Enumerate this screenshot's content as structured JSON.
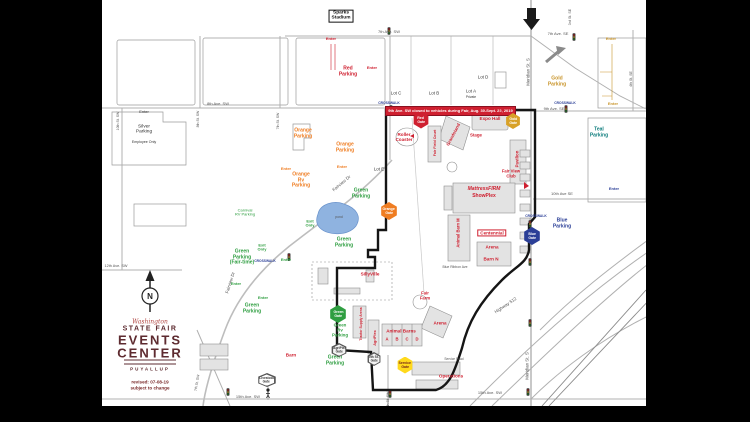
{
  "colors": {
    "accent_red": "#cf2030",
    "orange": "#ef7d22",
    "gold": "#c9952b",
    "green": "#2f9e41",
    "blue": "#2b3f97",
    "teal": "#0e7d7d",
    "maroon": "#5e2b30",
    "pond": "#8fb3e0",
    "boundary": "#151515"
  },
  "banner": {
    "text": "9th Ave. SW closed to vehicles during Fair, Aug. 30-Sept. 22, 2019"
  },
  "logo": {
    "script": "Washington",
    "name": "STATE FAIR",
    "big1": "EVENTS",
    "big2": "CENTER",
    "city": "PUYALLUP",
    "revised": "revised:  07-08-19",
    "subject": "subject to change",
    "compass_n": "N"
  },
  "labels": [
    {
      "id": "sparks-stadium-label",
      "lines": [
        "Sparks",
        "Stadium"
      ],
      "x": 239,
      "y": 16,
      "c": "black",
      "s": 4.8,
      "box": true
    },
    {
      "id": "street-7th-ave-sw",
      "t": "7th Ave. SW",
      "x": 287,
      "y": 32,
      "c": "street",
      "s": 4,
      "b": false
    },
    {
      "id": "street-7th-ave-se",
      "t": "7th Ave. SE",
      "x": 456,
      "y": 34,
      "c": "street",
      "s": 4,
      "b": false
    },
    {
      "id": "street-3rd-st-se",
      "t": "3rd St. SE",
      "x": 468,
      "y": 17,
      "c": "street",
      "s": 3.6,
      "b": false,
      "r": -90
    },
    {
      "id": "street-meridian-st-n",
      "t": "Meridian St. S",
      "x": 427,
      "y": 72,
      "c": "street",
      "s": 4.4,
      "b": false,
      "r": -90
    },
    {
      "id": "street-8th-ave-sw",
      "t": "8th Ave. SW",
      "x": 116,
      "y": 104,
      "c": "street",
      "s": 4,
      "b": false
    },
    {
      "id": "street-9th-ave-se",
      "t": "9th Ave. SE",
      "x": 452,
      "y": 109,
      "c": "street",
      "s": 4,
      "b": false
    },
    {
      "id": "street-10th-ave-se",
      "t": "10th Ave SE",
      "x": 460,
      "y": 194,
      "c": "street",
      "s": 4,
      "b": false
    },
    {
      "id": "street-12th-ave-sw",
      "t": "12th Ave. SW",
      "x": 14,
      "y": 266,
      "c": "street",
      "s": 3.8,
      "b": false
    },
    {
      "id": "street-15th-ave-sw-left",
      "t": "15th Ave. SW",
      "x": 146,
      "y": 397,
      "c": "street",
      "s": 4,
      "b": false
    },
    {
      "id": "street-15th-ave-sw-right",
      "t": "15th Ave. SW",
      "x": 388,
      "y": 393,
      "c": "street",
      "s": 4,
      "b": false
    },
    {
      "id": "street-meridian-st-s",
      "t": "Meridian St. S",
      "x": 426,
      "y": 366,
      "c": "street",
      "s": 4.4,
      "b": false,
      "r": -90
    },
    {
      "id": "street-highway-512",
      "t": "Highway 512",
      "x": 404,
      "y": 306,
      "c": "street",
      "s": 4.4,
      "b": false,
      "r": -34
    },
    {
      "id": "street-fairview-dr-upper",
      "t": "Fairview Dr",
      "x": 240,
      "y": 184,
      "c": "street",
      "s": 4.4,
      "b": false,
      "r": -40
    },
    {
      "id": "street-fairview-dr-lower",
      "t": "Fairview Dr",
      "x": 129,
      "y": 283,
      "c": "street",
      "s": 4.4,
      "b": false,
      "r": -72
    },
    {
      "id": "street-10th-st-sw",
      "t": "10th St. SW",
      "x": 17,
      "y": 121,
      "c": "street",
      "s": 3.5,
      "b": false,
      "r": -90
    },
    {
      "id": "street-8th-st-sw",
      "t": "8th St. SW",
      "x": 97,
      "y": 119,
      "c": "street",
      "s": 3.5,
      "b": false,
      "r": -90
    },
    {
      "id": "street-7th-st-sw",
      "t": "7th St. SW",
      "x": 177,
      "y": 121,
      "c": "street",
      "s": 3.5,
      "b": false,
      "r": -90
    },
    {
      "id": "street-4th-st-se",
      "t": "4th St. SE",
      "x": 530,
      "y": 79,
      "c": "street",
      "s": 3.5,
      "b": false,
      "r": -90
    },
    {
      "id": "street-7th-st-sw-south",
      "t": "7th St. SW",
      "x": 96,
      "y": 383,
      "c": "street",
      "s": 3.5,
      "b": false,
      "r": -80
    },
    {
      "id": "street-5th-st-sw",
      "t": "5th St. SW",
      "x": 287,
      "y": 400,
      "c": "street",
      "s": 3.5,
      "b": false,
      "r": -90
    },
    {
      "id": "street-blue-ribbon-ave",
      "t": "Blue Ribbon Ave",
      "x": 353,
      "y": 268,
      "c": "street",
      "s": 3.4,
      "b": false
    },
    {
      "id": "red-parking-label",
      "lines": [
        "Red",
        "Parking"
      ],
      "x": 246,
      "y": 72,
      "c": "red",
      "s": 5
    },
    {
      "id": "gold-parking-label",
      "lines": [
        "Gold",
        "Parking"
      ],
      "x": 455,
      "y": 82,
      "c": "gold",
      "s": 5
    },
    {
      "id": "silver-parking-label",
      "lines": [
        "Silver",
        "Parking"
      ],
      "x": 42,
      "y": 130,
      "c": "dkgray",
      "s": 4.8,
      "b": false
    },
    {
      "id": "silver-parking-note",
      "t": "Employee Only",
      "x": 42,
      "y": 142,
      "c": "dkgray",
      "s": 3.6,
      "b": false
    },
    {
      "id": "orange-parking-label-1",
      "lines": [
        "Orange",
        "Parking"
      ],
      "x": 201,
      "y": 134,
      "c": "orange",
      "s": 5
    },
    {
      "id": "orange-parking-label-2",
      "lines": [
        "Orange",
        "Parking"
      ],
      "x": 243,
      "y": 148,
      "c": "orange",
      "s": 5
    },
    {
      "id": "orange-rv-parking-label",
      "lines": [
        "Orange",
        "Rv",
        "Parking"
      ],
      "x": 199,
      "y": 181,
      "c": "orange",
      "s": 5
    },
    {
      "id": "teal-parking-label",
      "lines": [
        "Teal",
        "Parking"
      ],
      "x": 497,
      "y": 133,
      "c": "teal",
      "s": 5
    },
    {
      "id": "blue-parking-label",
      "lines": [
        "Blue",
        "Parking"
      ],
      "x": 460,
      "y": 224,
      "c": "blue",
      "s": 5
    },
    {
      "id": "green-parking-label-1",
      "lines": [
        "Green",
        "Parking"
      ],
      "x": 259,
      "y": 194,
      "c": "green",
      "s": 5
    },
    {
      "id": "green-parking-label-2",
      "lines": [
        "Green",
        "Parking"
      ],
      "x": 242,
      "y": 243,
      "c": "green",
      "s": 5
    },
    {
      "id": "green-parking-fairtime-label",
      "lines": [
        "Green",
        "Parking",
        "(Fair-time)"
      ],
      "x": 140,
      "y": 258,
      "c": "green",
      "s": 5
    },
    {
      "id": "green-parking-label-3",
      "lines": [
        "Green",
        "Parking"
      ],
      "x": 150,
      "y": 309,
      "c": "green",
      "s": 5
    },
    {
      "id": "green-parking-label-4",
      "lines": [
        "Green",
        "Parking"
      ],
      "x": 233,
      "y": 361,
      "c": "green",
      "s": 5
    },
    {
      "id": "carnival-rv-parking-label",
      "lines": [
        "Carnival",
        "RV Parking"
      ],
      "x": 143,
      "y": 213,
      "c": "green",
      "s": 4,
      "b": false
    },
    {
      "id": "green-rv-parking-label",
      "lines": [
        "Green",
        "Rv",
        "Parking"
      ],
      "x": 238,
      "y": 331,
      "c": "green",
      "s": 4.4
    },
    {
      "id": "lot-c-label",
      "t": "Lot C",
      "x": 294,
      "y": 94,
      "c": "dkgray",
      "s": 4.4,
      "b": false
    },
    {
      "id": "lot-b-label",
      "t": "Lot B",
      "x": 332,
      "y": 94,
      "c": "dkgray",
      "s": 4.4,
      "b": false
    },
    {
      "id": "lot-a-label",
      "t": "Lot A",
      "x": 369,
      "y": 92,
      "c": "dkgray",
      "s": 4.4,
      "b": false
    },
    {
      "id": "lot-a-private-note",
      "t": "Private",
      "x": 369,
      "y": 98,
      "c": "dkgray",
      "s": 3.3,
      "b": false
    },
    {
      "id": "lot-d-label",
      "t": "Lot D",
      "x": 381,
      "y": 78,
      "c": "dkgray",
      "s": 4.4,
      "b": false
    },
    {
      "id": "lot-e-label",
      "t": "Lot E",
      "x": 277,
      "y": 170,
      "c": "dkgray",
      "s": 4.4,
      "b": false
    },
    {
      "id": "enter-red-1",
      "t": "Enter",
      "x": 229,
      "y": 39,
      "c": "red",
      "s": 4
    },
    {
      "id": "enter-red-2",
      "t": "Enter",
      "x": 270,
      "y": 68,
      "c": "red",
      "s": 4
    },
    {
      "id": "enter-gold-1",
      "t": "Enter",
      "x": 509,
      "y": 39,
      "c": "gold",
      "s": 4
    },
    {
      "id": "enter-gold-2",
      "t": "Enter",
      "x": 511,
      "y": 104,
      "c": "gold",
      "s": 4
    },
    {
      "id": "enter-silver",
      "t": "Enter",
      "x": 42,
      "y": 112,
      "c": "dkgray",
      "s": 4,
      "b": false
    },
    {
      "id": "enter-orange-1",
      "t": "Enter",
      "x": 184,
      "y": 169,
      "c": "orange",
      "s": 4
    },
    {
      "id": "enter-orange-2",
      "t": "Enter",
      "x": 240,
      "y": 167,
      "c": "orange",
      "s": 4
    },
    {
      "id": "exit-only-1",
      "lines": [
        "Exit",
        "Only"
      ],
      "x": 208,
      "y": 224,
      "c": "green",
      "s": 4
    },
    {
      "id": "exit-only-2",
      "lines": [
        "Exit",
        "Only"
      ],
      "x": 160,
      "y": 248,
      "c": "green",
      "s": 4
    },
    {
      "id": "enter-green-1",
      "t": "Enter",
      "x": 184,
      "y": 260,
      "c": "green",
      "s": 4
    },
    {
      "id": "enter-green-2",
      "t": "Enter",
      "x": 134,
      "y": 284,
      "c": "green",
      "s": 4
    },
    {
      "id": "enter-green-3",
      "t": "Enter",
      "x": 161,
      "y": 298,
      "c": "green",
      "s": 4
    },
    {
      "id": "enter-blue",
      "t": "Enter",
      "x": 512,
      "y": 189,
      "c": "blue",
      "s": 4
    },
    {
      "id": "crosswalk-label-1",
      "t": "CROSSWALK",
      "x": 287,
      "y": 104,
      "c": "blue",
      "s": 3.3
    },
    {
      "id": "crosswalk-label-2",
      "t": "CROSSWALK",
      "x": 463,
      "y": 104,
      "c": "blue",
      "s": 3.3
    },
    {
      "id": "crosswalk-label-3",
      "t": "CROSSWALK",
      "x": 434,
      "y": 217,
      "c": "blue",
      "s": 3.3
    },
    {
      "id": "crosswalk-label-4",
      "t": "CROSSWALK",
      "x": 163,
      "y": 262,
      "c": "blue",
      "s": 3.3
    },
    {
      "id": "administration-expo-hall-label",
      "lines": [
        "Administration",
        "Expo Hall"
      ],
      "x": 388,
      "y": 116,
      "c": "red",
      "s": 4.6
    },
    {
      "id": "roller-coaster-label",
      "lines": [
        "Roller",
        "Coaster"
      ],
      "x": 302,
      "y": 137,
      "c": "red",
      "s": 4.6
    },
    {
      "id": "fair-field-court-label",
      "t": "Fair Field Court",
      "x": 333,
      "y": 143,
      "c": "red",
      "s": 3.6,
      "r": -90
    },
    {
      "id": "grandstand-label",
      "t": "Grandstand",
      "x": 352,
      "y": 135,
      "c": "red",
      "s": 4.4,
      "r": -62
    },
    {
      "id": "stage-label",
      "t": "Stage",
      "x": 374,
      "y": 136,
      "c": "red",
      "s": 4.4
    },
    {
      "id": "pavilion-label",
      "t": "Pavilion",
      "x": 416,
      "y": 159,
      "c": "red",
      "s": 4.4,
      "r": -90
    },
    {
      "id": "fair-view-club-label",
      "lines": [
        "Fair View",
        "Club"
      ],
      "x": 409,
      "y": 174,
      "c": "red",
      "s": 4.2
    },
    {
      "id": "showplex-sponsor-label",
      "t": "MattressFIRM",
      "x": 382,
      "y": 190,
      "c": "red",
      "s": 5,
      "i": true
    },
    {
      "id": "showplex-label",
      "t": "ShowPlex",
      "x": 382,
      "y": 197,
      "c": "red",
      "s": 5
    },
    {
      "id": "sillyville-label",
      "t": "SillyVille",
      "x": 268,
      "y": 274,
      "c": "red",
      "s": 4.6
    },
    {
      "id": "animal-barn-m-label",
      "t": "Animal Barn M",
      "x": 357,
      "y": 233,
      "c": "red",
      "s": 4.2,
      "r": -90
    },
    {
      "id": "centennial-label",
      "t": "Centennial",
      "x": 390,
      "y": 233,
      "c": "red",
      "s": 4.6,
      "box": true
    },
    {
      "id": "arena-north-label",
      "t": "Arena",
      "x": 390,
      "y": 247,
      "c": "red",
      "s": 4.6
    },
    {
      "id": "barn-n-label",
      "t": "Barn N",
      "x": 389,
      "y": 259,
      "c": "red",
      "s": 4.6
    },
    {
      "id": "fair-farm-label",
      "lines": [
        "Fair",
        "Farm"
      ],
      "x": 323,
      "y": 296,
      "c": "red",
      "s": 4.2
    },
    {
      "id": "arena-south-label",
      "t": "Arena",
      "x": 338,
      "y": 323,
      "c": "red",
      "s": 4.6
    },
    {
      "id": "animal-barns-label",
      "t": "Animal Barns",
      "x": 299,
      "y": 331,
      "c": "red",
      "s": 4.6
    },
    {
      "id": "animal-barn-a-label",
      "t": "A",
      "x": 285,
      "y": 340,
      "c": "red",
      "s": 4.2
    },
    {
      "id": "animal-barn-b-label",
      "t": "B",
      "x": 295,
      "y": 340,
      "c": "red",
      "s": 4.2
    },
    {
      "id": "animal-barn-c-label",
      "t": "C",
      "x": 305,
      "y": 340,
      "c": "red",
      "s": 4.2
    },
    {
      "id": "animal-barn-d-label",
      "t": "D",
      "x": 315,
      "y": 340,
      "c": "red",
      "s": 4.2
    },
    {
      "id": "agriplex-label",
      "t": "AgriPlex",
      "x": 273,
      "y": 338,
      "c": "red",
      "s": 3.8,
      "r": -90
    },
    {
      "id": "tractor-supply-arena-label",
      "t": "Tractor Supply Arena",
      "x": 260,
      "y": 324,
      "c": "red",
      "s": 3.3,
      "r": -90
    },
    {
      "id": "operations-label",
      "t": "Operations",
      "x": 349,
      "y": 376,
      "c": "red",
      "s": 4.6
    },
    {
      "id": "barn-label",
      "t": "Barn",
      "x": 189,
      "y": 355,
      "c": "red",
      "s": 4.6
    },
    {
      "id": "service-road-label",
      "t": "Service Road",
      "x": 352,
      "y": 360,
      "c": "street",
      "s": 3.2,
      "b": false
    },
    {
      "id": "pond-label",
      "t": "pond",
      "x": 237,
      "y": 218,
      "c": "street",
      "s": 3.4,
      "b": false
    }
  ],
  "gates": [
    {
      "id": "red-gate",
      "lines": [
        "Red",
        "Gate"
      ],
      "x": 319,
      "y": 120,
      "w": 16,
      "h": 17,
      "bg": "#cf2030",
      "fg": "#fff"
    },
    {
      "id": "gold-gate",
      "lines": [
        "Gold",
        "Gate"
      ],
      "x": 411,
      "y": 121,
      "w": 15,
      "h": 16,
      "bg": "#d8a127",
      "fg": "#fff"
    },
    {
      "id": "orange-gate",
      "lines": [
        "Orange",
        "Gate"
      ],
      "x": 287,
      "y": 211,
      "w": 17,
      "h": 18,
      "bg": "#ef7d22",
      "fg": "#fff"
    },
    {
      "id": "blue-gate",
      "lines": [
        "Blue",
        "Gate"
      ],
      "x": 430,
      "y": 236,
      "w": 17,
      "h": 18,
      "bg": "#2b3f97",
      "fg": "#fff"
    },
    {
      "id": "green-gate",
      "lines": [
        "Green",
        "Gate"
      ],
      "x": 236,
      "y": 314,
      "w": 17,
      "h": 18,
      "bg": "#2f9e41",
      "fg": "#fff"
    },
    {
      "id": "agriplex-gate",
      "lines": [
        "AgriPlex",
        "Gate"
      ],
      "x": 237,
      "y": 350,
      "w": 16,
      "h": 14,
      "bg": "#f4f4f4",
      "fg": "#333",
      "bd": "#555"
    },
    {
      "id": "fifth-st-gate",
      "lines": [
        "5th St.",
        "Gate"
      ],
      "x": 272,
      "y": 359,
      "w": 14,
      "h": 14,
      "bg": "#f4f4f4",
      "fg": "#333",
      "bd": "#555"
    },
    {
      "id": "service-gate",
      "lines": [
        "Service",
        "Gate"
      ],
      "x": 303,
      "y": 365,
      "w": 16,
      "h": 17,
      "bg": "#ffd91c",
      "fg": "#6b1a1a"
    },
    {
      "id": "livestock-gate",
      "lines": [
        "Livestock",
        "Gate"
      ],
      "x": 165,
      "y": 380,
      "w": 19,
      "h": 14,
      "bg": "#ffffff",
      "fg": "#333",
      "bd": "#555"
    }
  ]
}
